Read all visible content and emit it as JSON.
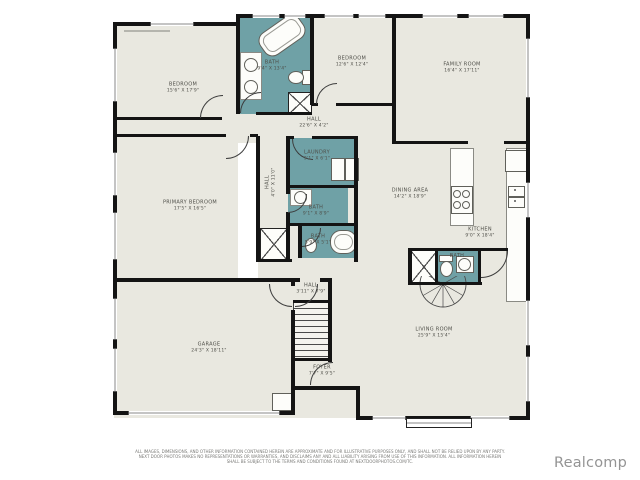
{
  "colors": {
    "wall": "#141414",
    "room_fill": "#e9e8e0",
    "wet_room_fill": "#6fa1a6",
    "label_text": "#4e4e48",
    "watermark_gray": "#949494"
  },
  "rooms": [
    {
      "name": "BEDROOM",
      "dims": "15'6\" X 17'9\""
    },
    {
      "name": "BATH",
      "dims": "9'4\" X 13'4\""
    },
    {
      "name": "BEDROOM",
      "dims": "12'6\" X 12'4\""
    },
    {
      "name": "FAMILY ROOM",
      "dims": "16'4\" X 17'11\""
    },
    {
      "name": "HALL",
      "dims": "22'6\" X 4'2\""
    },
    {
      "name": "LAUNDRY",
      "dims": "9'1\" X 6'1\""
    },
    {
      "name": "PRIMARY BEDROOM",
      "dims": "17'5\" X 16'5\""
    },
    {
      "name": "HALL",
      "dims": "4'0\" X 11'0\""
    },
    {
      "name": "BATH",
      "dims": "9'1\" X 8'9\""
    },
    {
      "name": "BATH",
      "dims": "5'9\" X 5'1\""
    },
    {
      "name": "DINING AREA",
      "dims": "14'2\" X 18'9\""
    },
    {
      "name": "KITCHEN",
      "dims": "9'0\" X 18'4\""
    },
    {
      "name": "BATH",
      "dims": ""
    },
    {
      "name": "HALL",
      "dims": "3'11\" X 7'9\""
    },
    {
      "name": "GARAGE",
      "dims": "24'3\" X 18'11\""
    },
    {
      "name": "FOYER",
      "dims": "7'7\" X 9'5\""
    },
    {
      "name": "LIVING ROOM",
      "dims": "25'9\" X 15'4\""
    }
  ],
  "footer": {
    "line1": "ALL IMAGES, DIMENSIONS, AND OTHER INFORMATION CONTAINED HEREIN ARE APPROXIMATE AND FOR ILLUSTRATIVE PURPOSES ONLY, AND SHALL NOT BE RELIED UPON BY ANY PARTY.",
    "line2": "NEXT DOOR PHOTOS MAKES NO REPRESENTATIONS OR WARRANTIES, AND DISCLAIMS ANY AND ALL LIABILITY ARISING FROM USE OF THIS INFORMATION. ALL INFORMATION HEREIN",
    "line3": "SHALL BE SUBJECT TO THE TERMS AND CONDITIONS FOUND AT NEXTDOORPHOTOS.COM/TC."
  },
  "watermark": {
    "text": "Realcomp"
  }
}
